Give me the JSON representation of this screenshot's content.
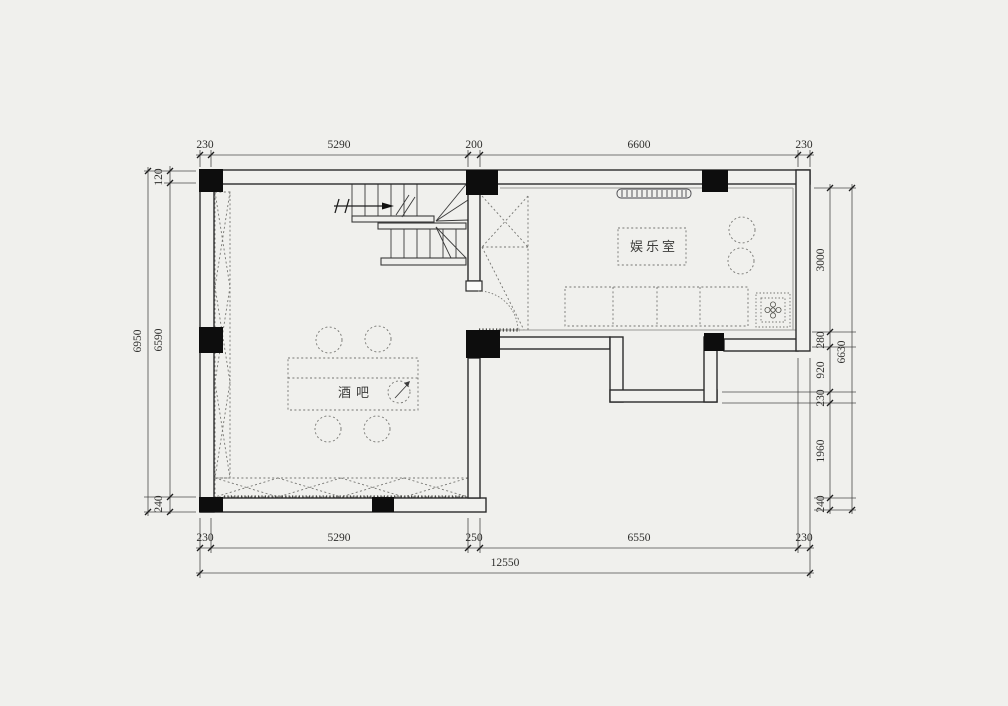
{
  "plan": {
    "rooms": {
      "bar": {
        "label": "酒吧"
      },
      "entertainment": {
        "label": "娱乐室"
      }
    },
    "dimensions": {
      "top": [
        "230",
        "5290",
        "200",
        "6600",
        "230"
      ],
      "bottom": [
        "230",
        "5290",
        "250",
        "6550",
        "230"
      ],
      "bottom_total": "12550",
      "left_chain": [
        "120",
        "6590",
        "240"
      ],
      "left_outer": "6950",
      "right_chain": [
        "3000",
        "280",
        "920",
        "230",
        "1960",
        "240"
      ],
      "right_outer": "6630"
    },
    "symbols": {
      "stair_arrow": "direction-arrow-right",
      "decor": "plant-flower-symbol",
      "bar_marker": "rotation-arrow-circle"
    },
    "colors": {
      "background": "#f0f0ed",
      "line": "#2b2b2b",
      "column_fill": "#0d0d0d",
      "dashed": "#767672"
    }
  }
}
